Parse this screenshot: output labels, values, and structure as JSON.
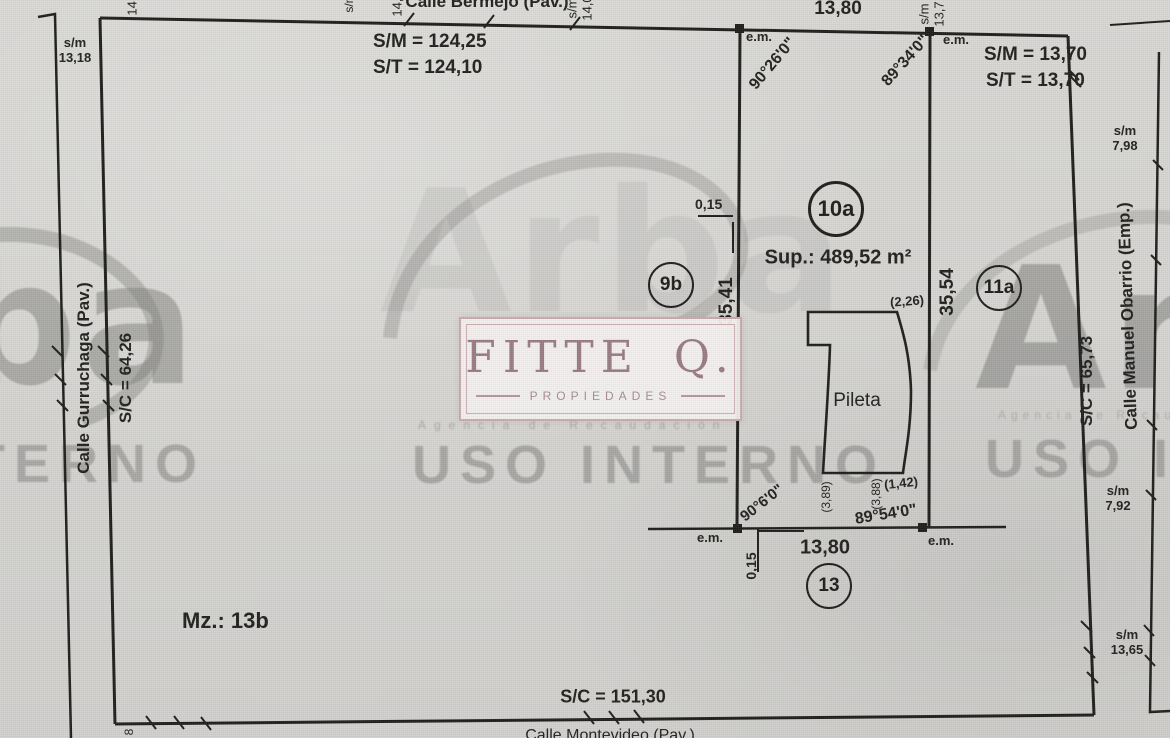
{
  "labels": {
    "street_top": "Calle Bermejo (Pav.)",
    "street_left": "Calle Gurruchaga (Pav.)",
    "street_right": "Calle Manuel Obarrio (Emp.)",
    "street_bottom": "Calle Montevideo (Pav.)",
    "block": "Mz.: 13b",
    "sm_top": "S/M = 124,25",
    "st_top": "S/T = 124,10",
    "sm_lot": "S/M = 13,70",
    "st_lot": "S/T = 13,70",
    "sc_left": "S/C = 64,26",
    "sc_right": "S/C = 65,73",
    "sc_bottom": "S/C = 151,30",
    "lot_id": "10a",
    "lot_area": "Sup.: 489,52 m²",
    "neighbor_left": "9b",
    "neighbor_right": "11a",
    "neighbor_back": "13",
    "dim_front": "13,80",
    "dim_back": "13,80",
    "dim_side_left": "35,41",
    "dim_side_right": "35,54",
    "dim_offset_top": "0,15",
    "dim_offset_bottom": "0,15",
    "angle_nw": "90°26'0\"",
    "angle_ne": "89°34'0\"",
    "angle_sw": "90°6'0\"",
    "angle_se": "89°54'0\"",
    "em": "e.m.",
    "pool": "Pileta",
    "pool_dim_top": "(2,26)",
    "pool_dim_right": "(1,42)",
    "pool_dim_b1": "(3,89)",
    "pool_dim_b2": "(3,88)",
    "note_nw": "s/m\n13,18",
    "note_ne": "s/m\n7,98",
    "note_e": "s/m\n7,92",
    "note_se": "s/m\n13,65",
    "frag_top_left": "14,0",
    "frag_top_a": "s/m",
    "frag_top_b": "14,0",
    "frag_top_mid": "s/m\n14,0",
    "frag_top_lot": "s/m\n13,7",
    "frag_bottom_left": "8"
  },
  "logo": {
    "wordmark": "FITTE",
    "initial": "Q.",
    "tagline": "PROPIEDADES"
  },
  "watermark": {
    "brand": "Arba",
    "agency": "Agencia de Recaudación",
    "internal": "USO INTERNO"
  },
  "colors": {
    "paper": "#d6d5d2",
    "ink": "#1d1d1b",
    "logo_text": "#997c83",
    "logo_border": "#c9abb0",
    "watermark_gray": "#8f8e8c"
  }
}
